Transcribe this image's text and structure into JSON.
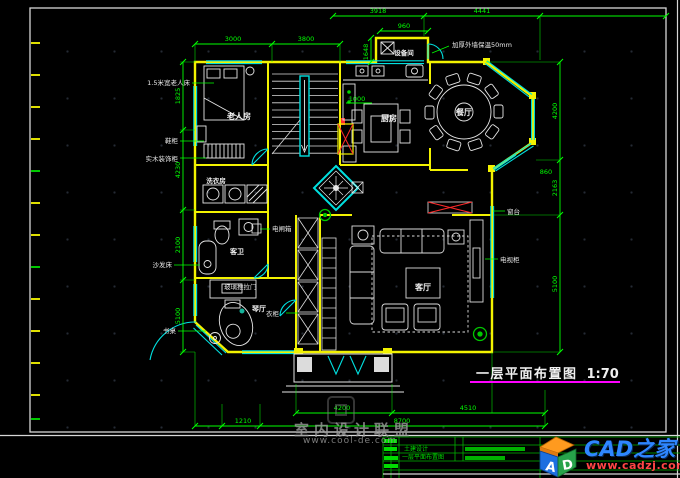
{
  "title": {
    "text": "一层平面布置图",
    "scale": "1:70"
  },
  "rooms": {
    "elder": "老人房",
    "kitchen": "厨房",
    "dining": "餐厅",
    "equipment": "设备间",
    "laundry": "洗衣房",
    "guest_bath": "客卫",
    "piano": "琴厅",
    "living": "客厅"
  },
  "annotations": {
    "elder_bed": "1.5米宽老人床",
    "shoe_cabinet": "鞋柜",
    "wood_cabinet": "实木装饰柜",
    "sofa_bed": "沙发床",
    "desk": "书桌",
    "breaker": "电闸箱",
    "wardrobe": "衣柜",
    "sill": "窗台",
    "tv": "电视柜",
    "insulation": "加厚外墙保温50mm",
    "glass_door": "玻璃推拉门"
  },
  "dims": {
    "top1_a": "3918",
    "top1_b": "4441",
    "top2_a": "3000",
    "top2_b": "3800",
    "equip_w": "960",
    "equip_h": "1648",
    "kitchen_a": "1000",
    "left_a": "1825",
    "left_b": "4230",
    "left_c": "2100",
    "left_d": "5100",
    "right_a": "4200",
    "right_b": "860",
    "right_c": "2163",
    "right_d": "5100",
    "bottom_a": "4200",
    "bottom_b": "4510",
    "bottom_c": "1210",
    "bottom_d": "8700"
  },
  "watermark": {
    "line1": "室内设计联盟",
    "line2": "www.cool-de.com"
  },
  "logo": {
    "site": "CAD之家",
    "url": "www.cadzj.com",
    "cube_a": "A",
    "cube_d": "D"
  },
  "titleblock": {
    "row1": "土建设计",
    "row2": "一层平面布置图"
  },
  "colors": {
    "wall": "#f2f200",
    "window": "#00e0e0",
    "dimension": "#00ff00",
    "underline": "#ff00ff",
    "logo_blue": "#2e86ff",
    "logo_red": "#ff4545",
    "titleblock_green": "#00dd00"
  }
}
